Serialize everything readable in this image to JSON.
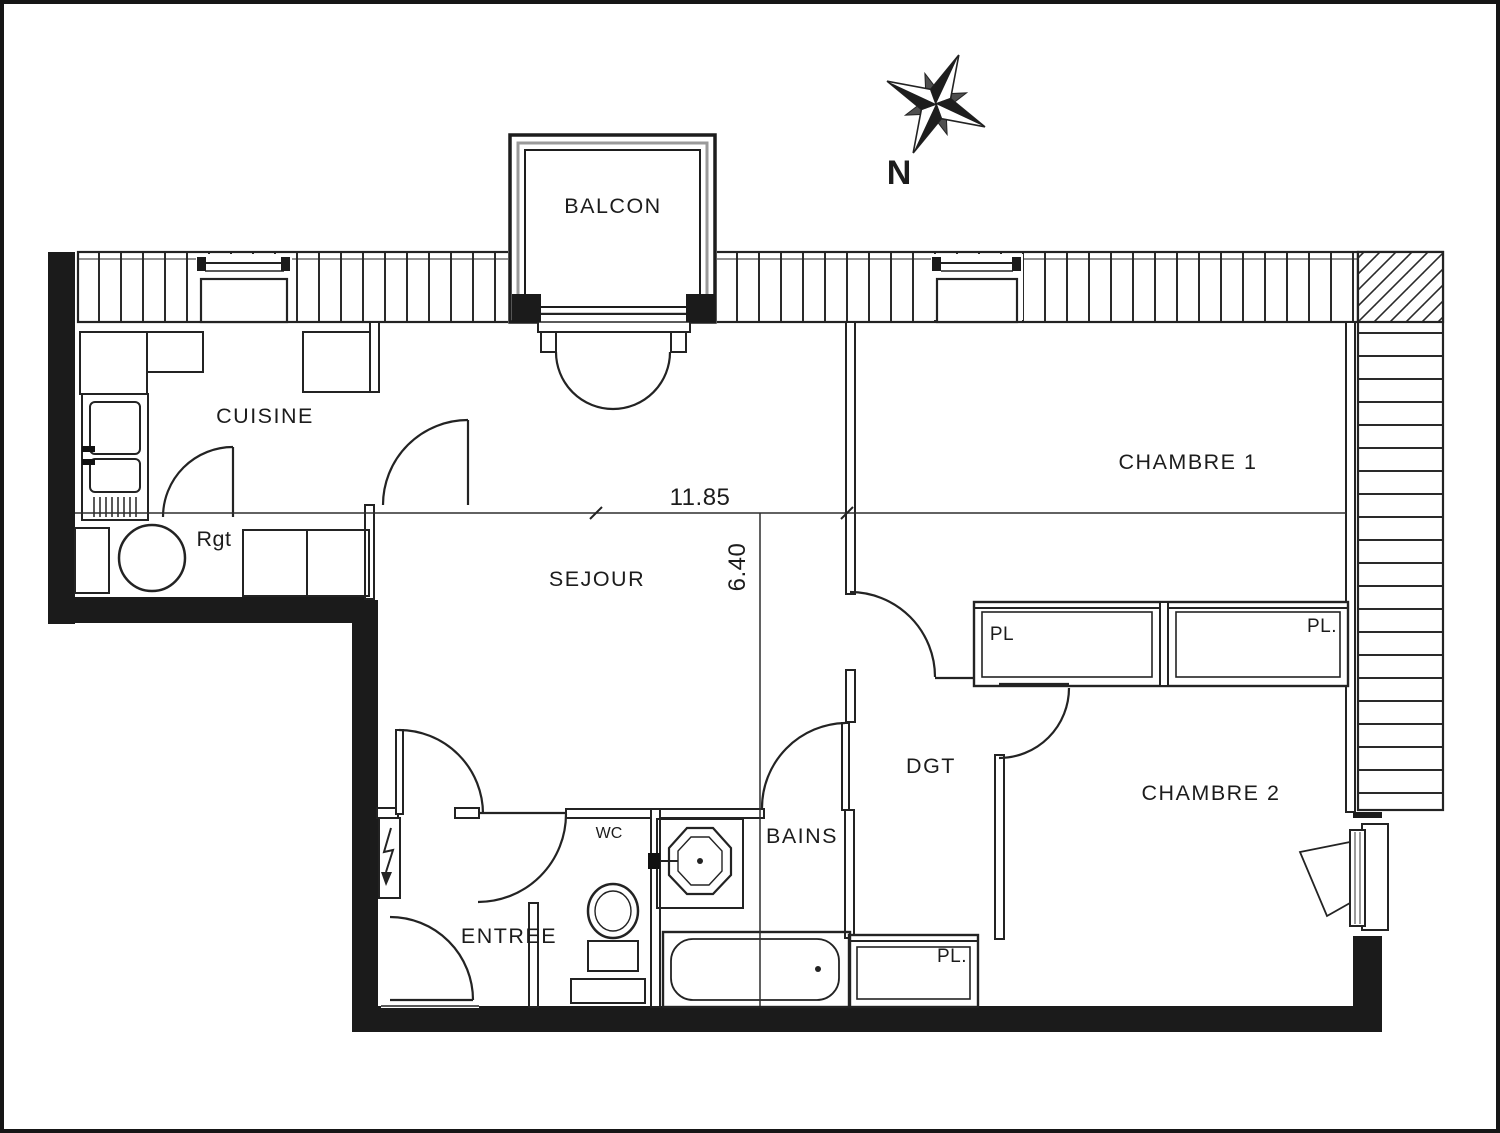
{
  "plan": {
    "type": "apartment-floor-plan",
    "compass": {
      "north": "N"
    },
    "rooms": {
      "balcon": "BALCON",
      "cuisine": "CUISINE",
      "chambre1": "CHAMBRE 1",
      "sejour": "SEJOUR",
      "chambre2": "CHAMBRE 2",
      "dgt": "DGT",
      "bains": "BAINS",
      "entree": "ENTREE",
      "wc": "WC",
      "rgt": "Rgt"
    },
    "closets": {
      "pl_chambre1_left": "PL",
      "pl_chambre1_right": "PL.",
      "pl_dgt": "PL."
    },
    "dimensions": {
      "width_m": "11.85",
      "depth_m": "6.40"
    },
    "colors": {
      "ink": "#232323",
      "wall_black": "#1b1b1b",
      "paper": "#ffffff"
    }
  }
}
